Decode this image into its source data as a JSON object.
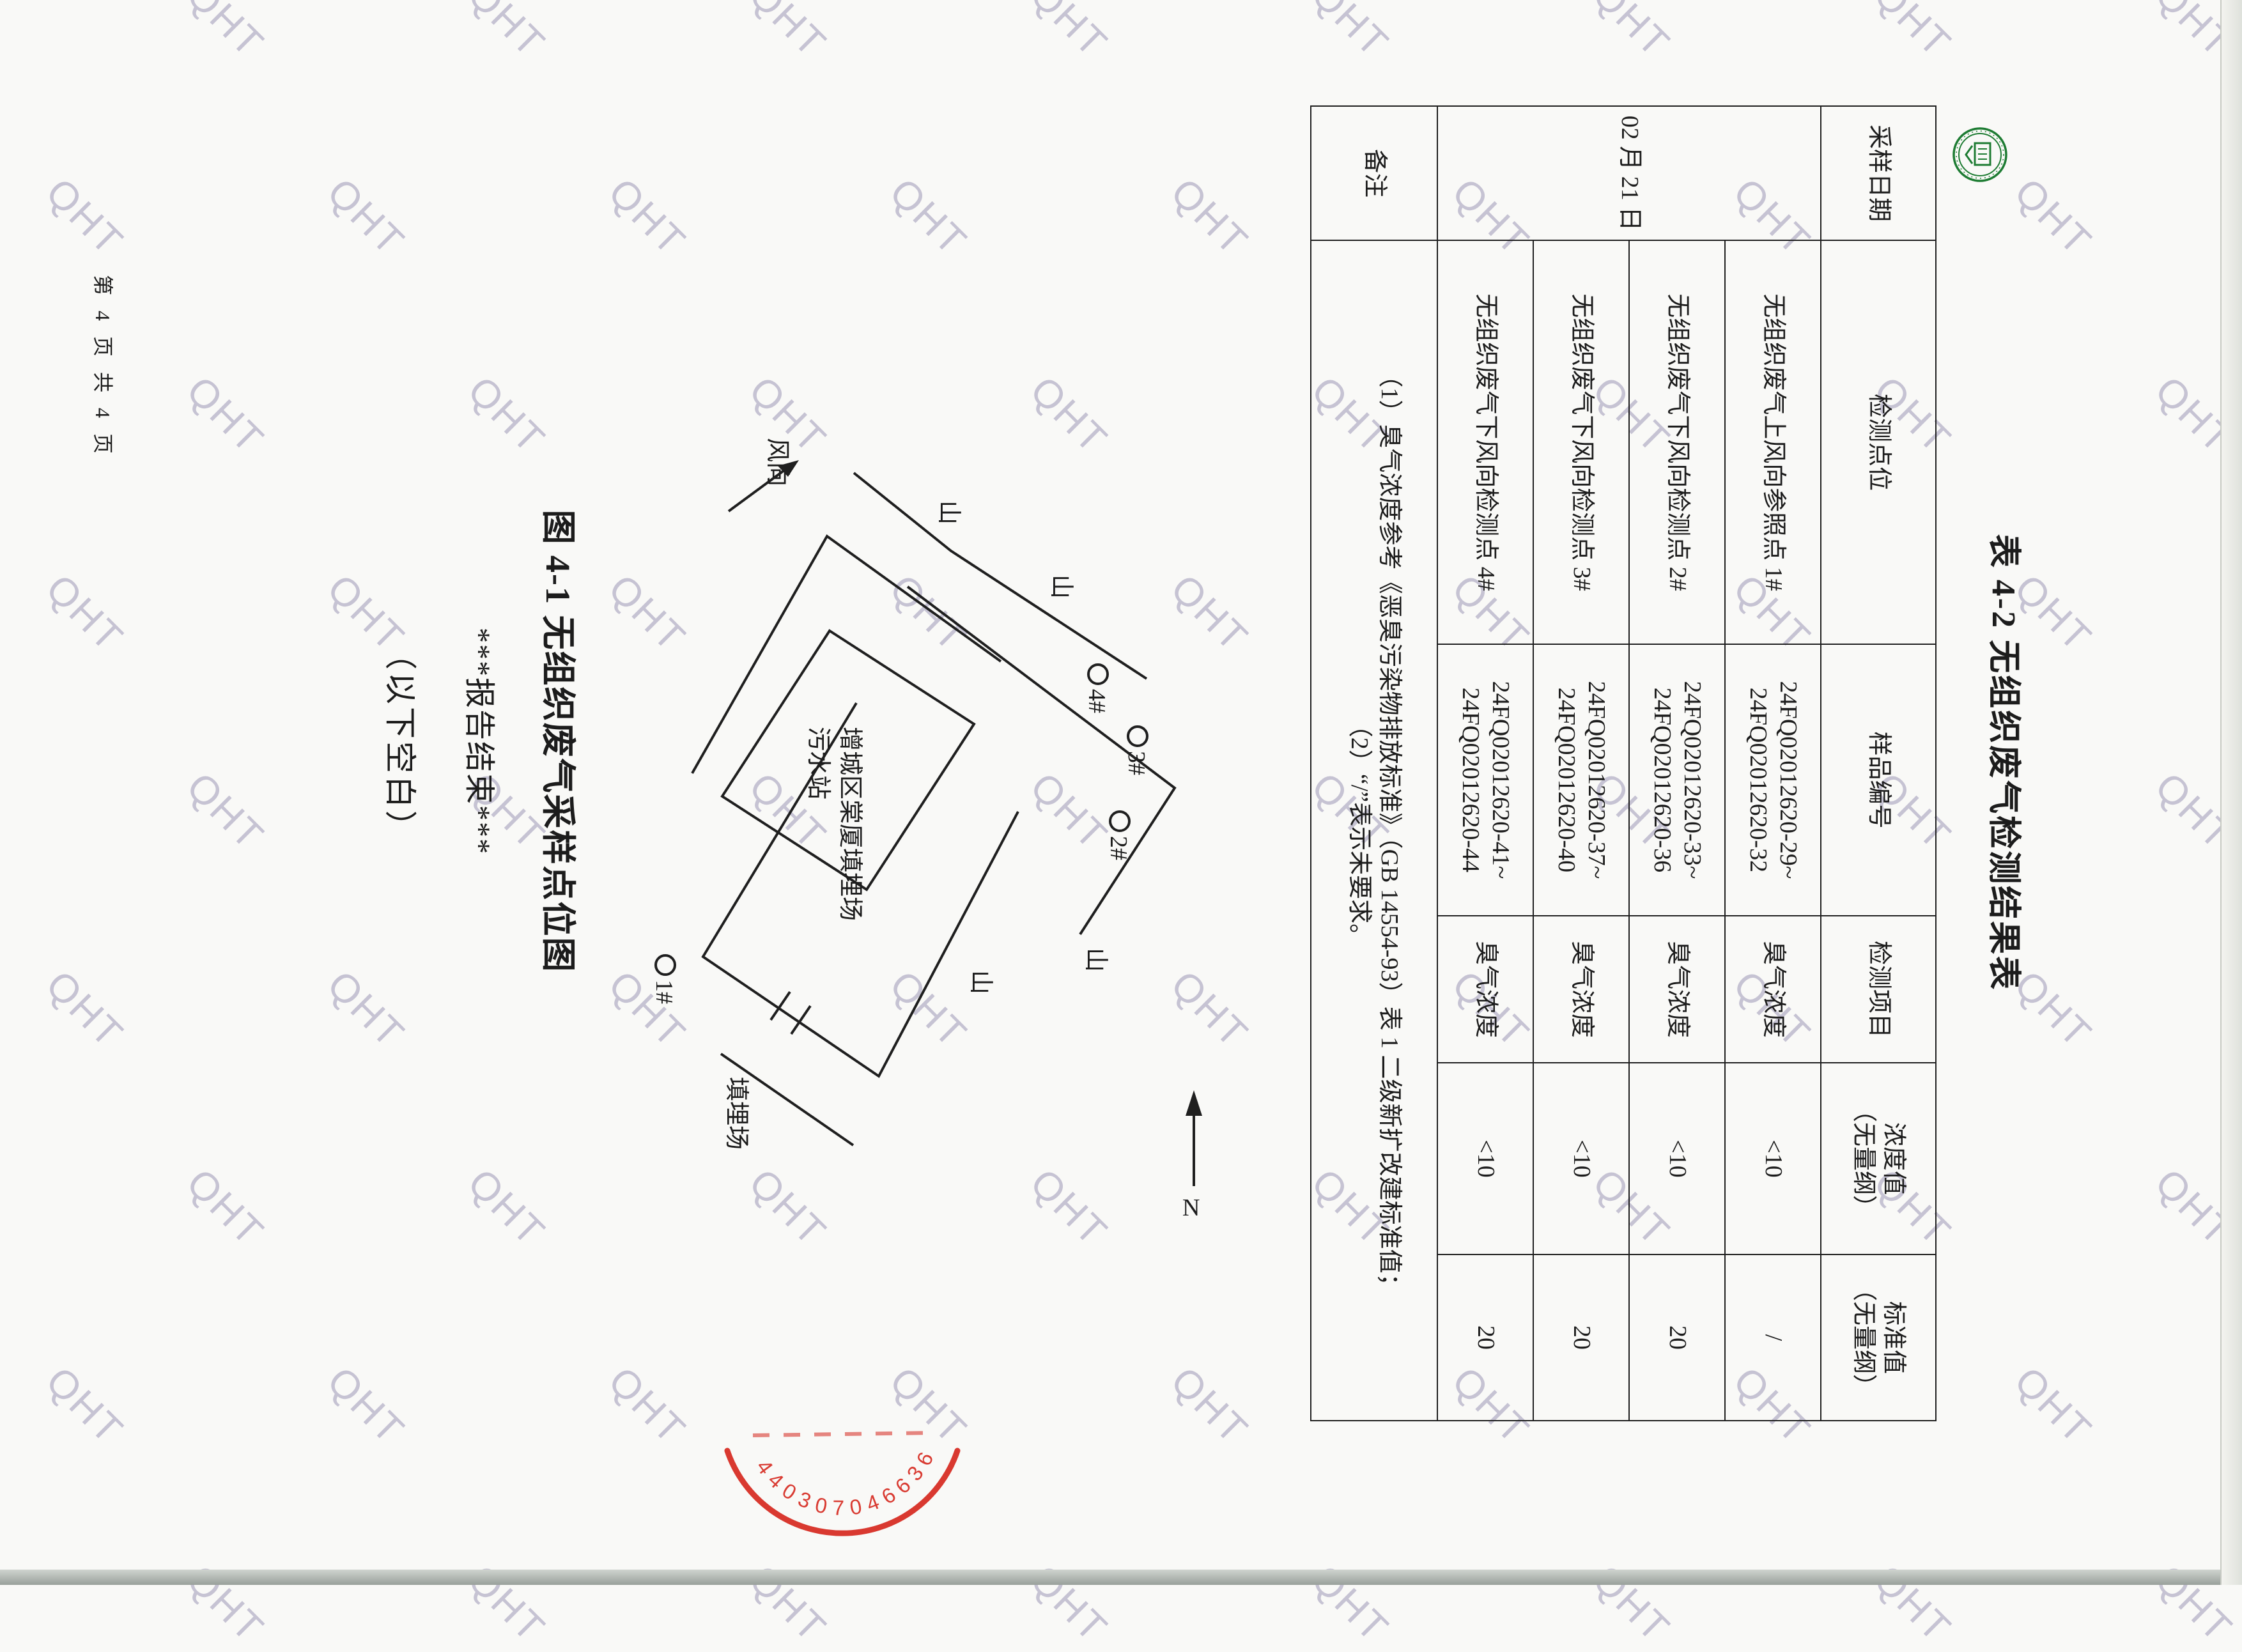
{
  "page": {
    "watermark_text": "QHT",
    "footer_text": "第 4 页 共 4 页"
  },
  "report_table": {
    "title": "表 4-2 无组织废气检测结果表",
    "headers": {
      "sampling_date": "采样日期",
      "point": "检测点位",
      "sample_id": "样品编号",
      "item": "检测项目",
      "concentration_l1": "浓度值",
      "concentration_l2": "（无量纲）",
      "standard_l1": "标准值",
      "standard_l2": "（无量纲）"
    },
    "sampling_date": "02 月 21 日",
    "rows": [
      {
        "point": "无组织废气上风向参照点 1#",
        "sample_id_1": "24FQ02012620-29~",
        "sample_id_2": "24FQ02012620-32",
        "item": "臭气浓度",
        "concentration": "<10",
        "standard": "/"
      },
      {
        "point": "无组织废气下风向检测点 2#",
        "sample_id_1": "24FQ02012620-33~",
        "sample_id_2": "24FQ02012620-36",
        "item": "臭气浓度",
        "concentration": "<10",
        "standard": "20"
      },
      {
        "point": "无组织废气下风向检测点 3#",
        "sample_id_1": "24FQ02012620-37~",
        "sample_id_2": "24FQ02012620-40",
        "item": "臭气浓度",
        "concentration": "<10",
        "standard": "20"
      },
      {
        "point": "无组织废气下风向检测点 4#",
        "sample_id_1": "24FQ02012620-41~",
        "sample_id_2": "24FQ02012620-44",
        "item": "臭气浓度",
        "concentration": "<10",
        "standard": "20"
      }
    ],
    "remark_label": "备注",
    "remark_note_1": "（1）臭气浓度参考《恶臭污染物排放标准》（GB 14554-93）表 1 二级新扩改建标准值；",
    "remark_note_2": "（2）“/”表示未要求。"
  },
  "figure": {
    "caption": "图 4-1 无组织废气采样点位图",
    "wind_label": "风向",
    "north_label": "N",
    "mountain_label_1": "山",
    "mountain_label_2": "山",
    "mountain_label_3": "山",
    "mountain_label_4": "山",
    "landfill_label": "填埋场",
    "site_name_line1": "增城区棠厦填埋场",
    "site_name_line2": "污水站",
    "point_1": "1#",
    "point_2": "2#",
    "point_3": "3#",
    "point_4": "4#"
  },
  "closing": {
    "report_end": "***报告结束***",
    "blank_below": "（以下空白）"
  },
  "seals": {
    "red_seal_code": "4403070466365"
  }
}
